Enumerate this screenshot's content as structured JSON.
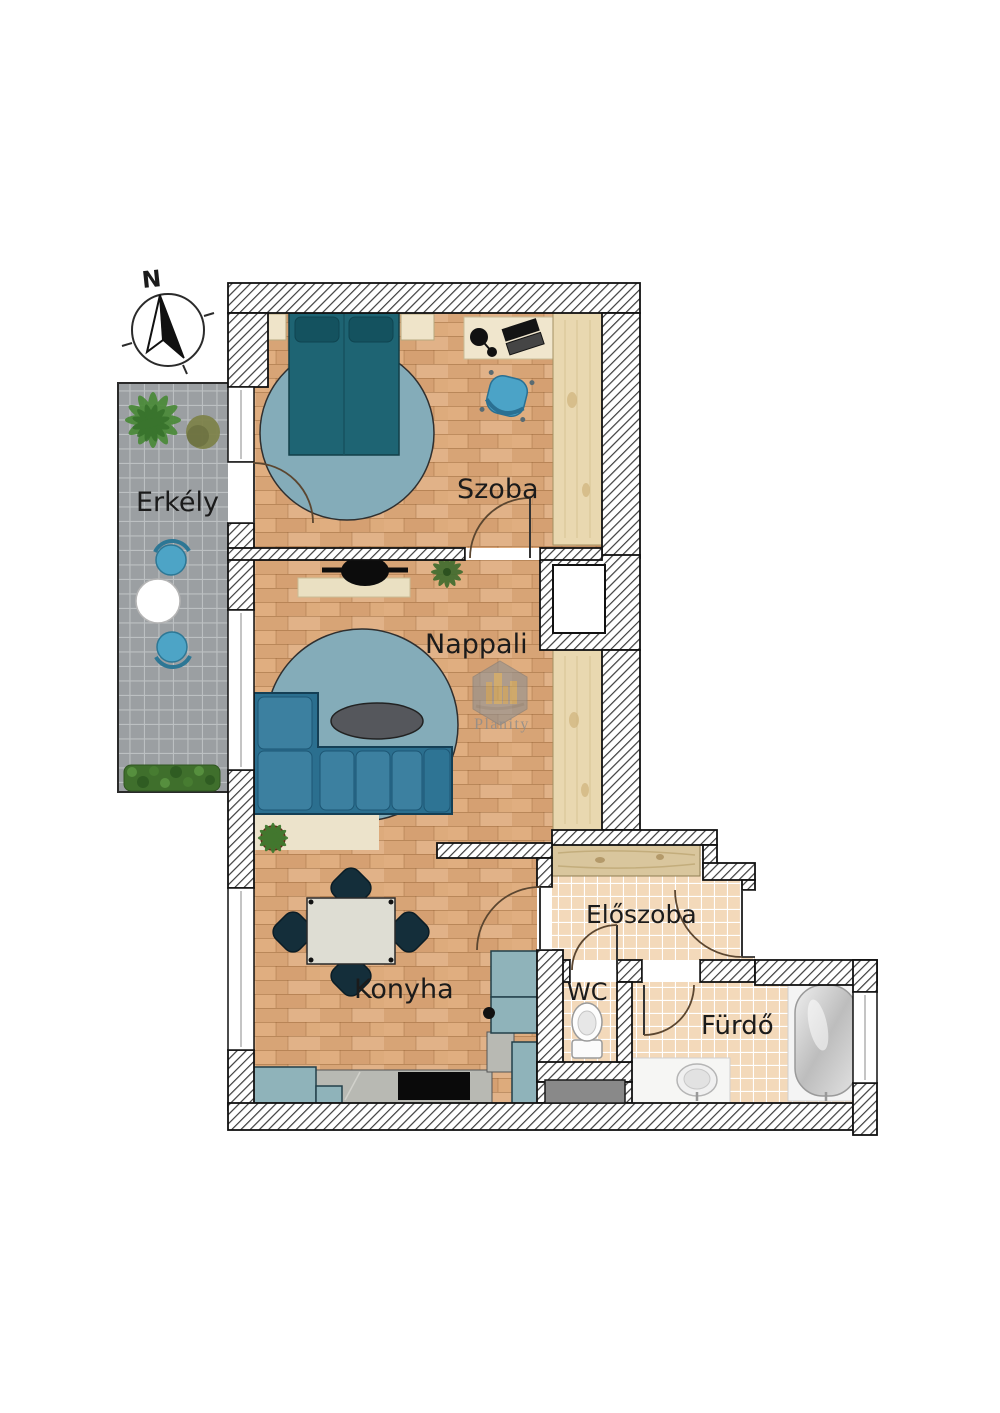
{
  "title": "Apartment floor plan",
  "compass": {
    "north_label": "N"
  },
  "rooms": {
    "erkely": {
      "label": "Erkély"
    },
    "szoba": {
      "label": "Szoba"
    },
    "nappali": {
      "label": "Nappali"
    },
    "konyha": {
      "label": "Konyha"
    },
    "eloszoba": {
      "label": "Előszoba"
    },
    "wc": {
      "label": "WC"
    },
    "furdo": {
      "label": "Fürdő"
    }
  },
  "watermark": {
    "brand": "Planity"
  },
  "palette": {
    "wood_floor": "#dcab7e",
    "bath_tile": "#f3d9ba",
    "balcony_tile": "#9b9fa2",
    "wall_outline": "#111111",
    "bed": "#1e6473",
    "sofa": "#2b6f8f",
    "rug": "#84acb9",
    "kitchen_cabinet_blue": "#8fb3ba",
    "chair_blue": "#4da4c6",
    "dark_chair": "#142e3a",
    "counter_gray": "#b8b9b3",
    "plant_green": "#4a8a38",
    "door_arc": "#5b4630"
  }
}
